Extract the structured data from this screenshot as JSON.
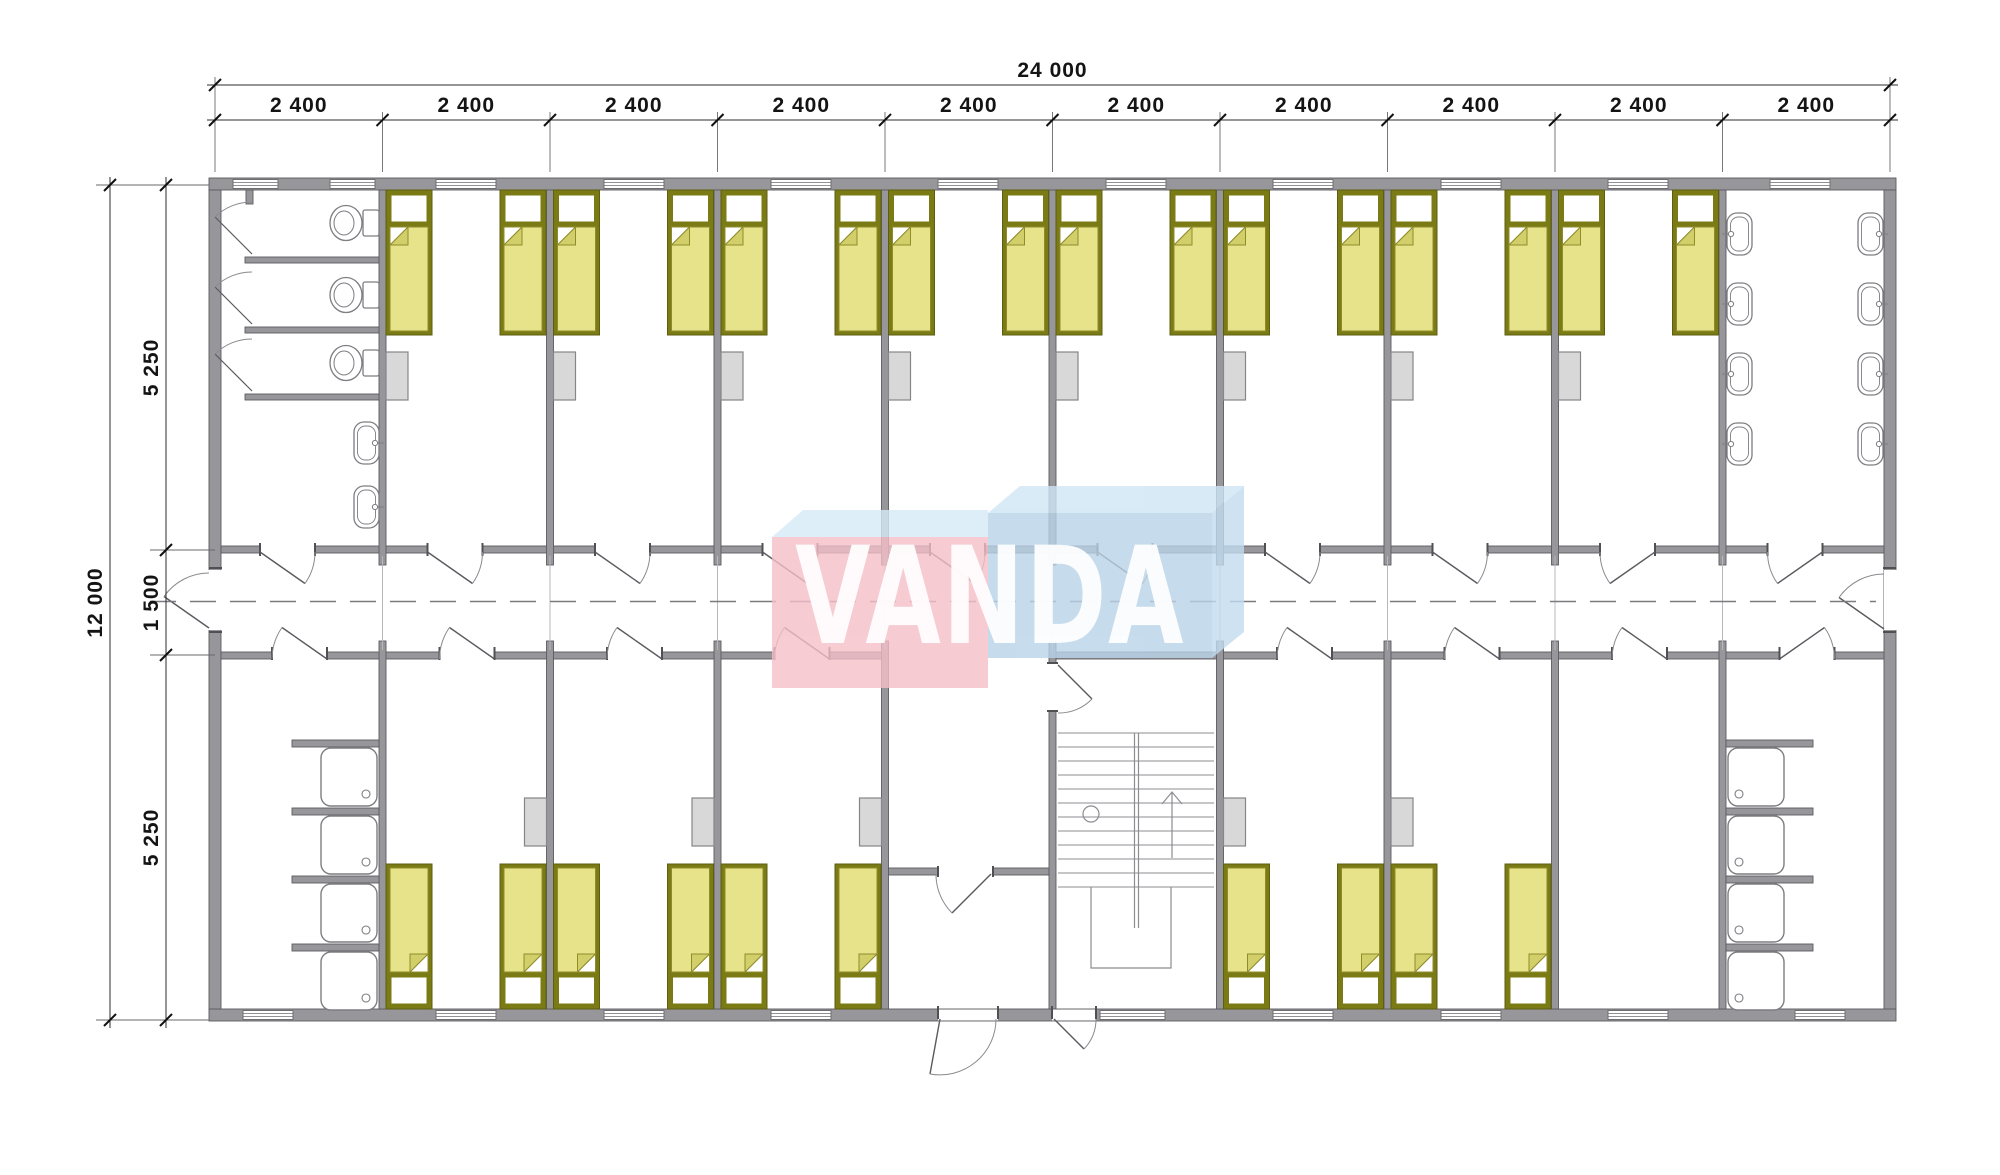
{
  "drawing": {
    "watermark": {
      "text": "VANDA",
      "pink": "#f5bfc8",
      "pink_top": "#d6ebf8",
      "blue_front": "#b9d3e8",
      "blue_top": "#cfe6f5",
      "blue_side": "#c2dcef",
      "text_color": "rgba(255,255,255,0.92)"
    },
    "dimensions": {
      "top_total_label": "24 000",
      "top_segment_labels": [
        "2 400",
        "2 400",
        "2 400",
        "2 400",
        "2 400",
        "2 400",
        "2 400",
        "2 400",
        "2 400",
        "2 400"
      ],
      "left_total_label": "12 000",
      "left_segment_labels": [
        "5 250",
        "1 500",
        "5 250"
      ]
    },
    "colors": {
      "wall": "#97979b",
      "wall_edge": "#5b5b60",
      "fixture_line": "#7d7d82",
      "bed_frame": "#7b7b16",
      "bed_blanket": "#e6e38b",
      "bed_fold": "#d2ce6a",
      "wardrobe": "#d8d8d8",
      "dimension_text": "#141414"
    }
  }
}
